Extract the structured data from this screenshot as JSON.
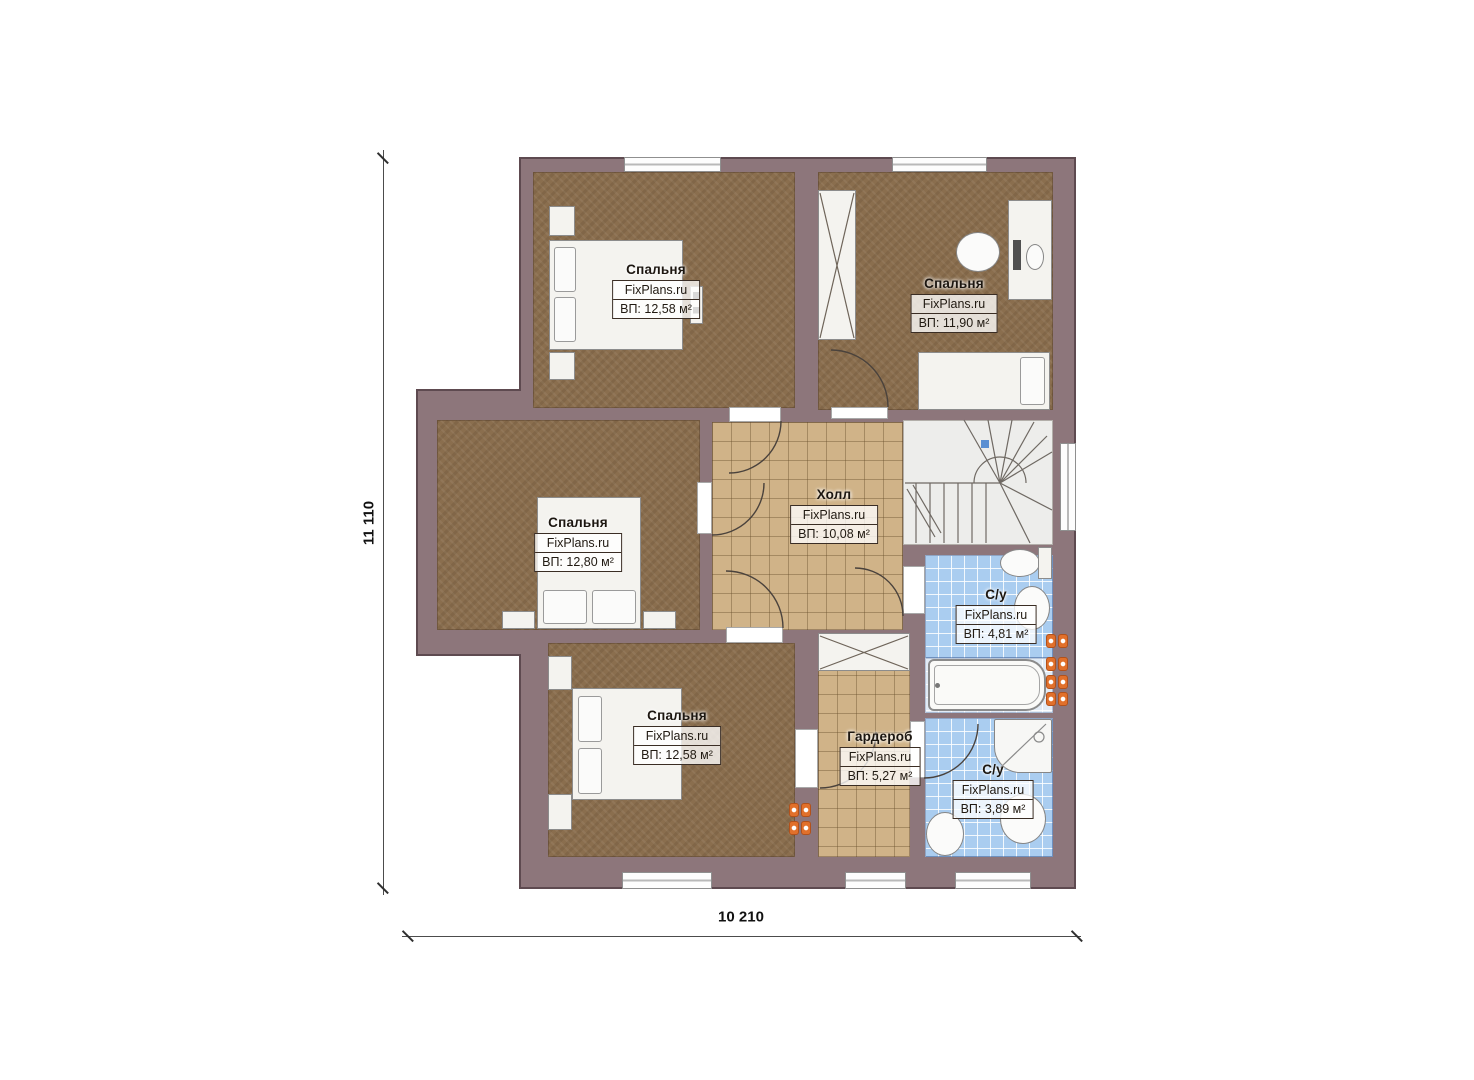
{
  "plan_title": "Floor plan — second floor",
  "brand": "FixPlans.ru",
  "dimensions": {
    "left_total": "11 110",
    "bottom_total": "10 210"
  },
  "rooms": [
    {
      "id": "bedroom-top-left",
      "name": "Спальня",
      "area": "ВП: 12,58 м²"
    },
    {
      "id": "bedroom-top-right",
      "name": "Спальня",
      "area": "ВП: 11,90 м²"
    },
    {
      "id": "bedroom-mid-left",
      "name": "Спальня",
      "area": "ВП: 12,80 м²"
    },
    {
      "id": "bedroom-bottom-left",
      "name": "Спальня",
      "area": "ВП: 12,58 м²"
    },
    {
      "id": "hall",
      "name": "Холл",
      "area": "ВП: 10,08 м²"
    },
    {
      "id": "bathroom-upper",
      "name": "С/у",
      "area": "ВП: 4,81 м²"
    },
    {
      "id": "wardrobe",
      "name": "Гардероб",
      "area": "ВП: 5,27 м²"
    },
    {
      "id": "bathroom-lower",
      "name": "С/у",
      "area": "ВП: 3,89 м²"
    }
  ],
  "colors": {
    "wall": "#8d767b",
    "wall_outline": "#5e4a50",
    "bedroom_floor": "#8a6e4e",
    "tile_floor_tan": "#d0b388",
    "bathroom_floor_blue": "#aacdf0",
    "stairs_floor": "#ededeb",
    "radiator_orange": "#e1702b",
    "stair_marker_blue": "#5b8fd2"
  }
}
